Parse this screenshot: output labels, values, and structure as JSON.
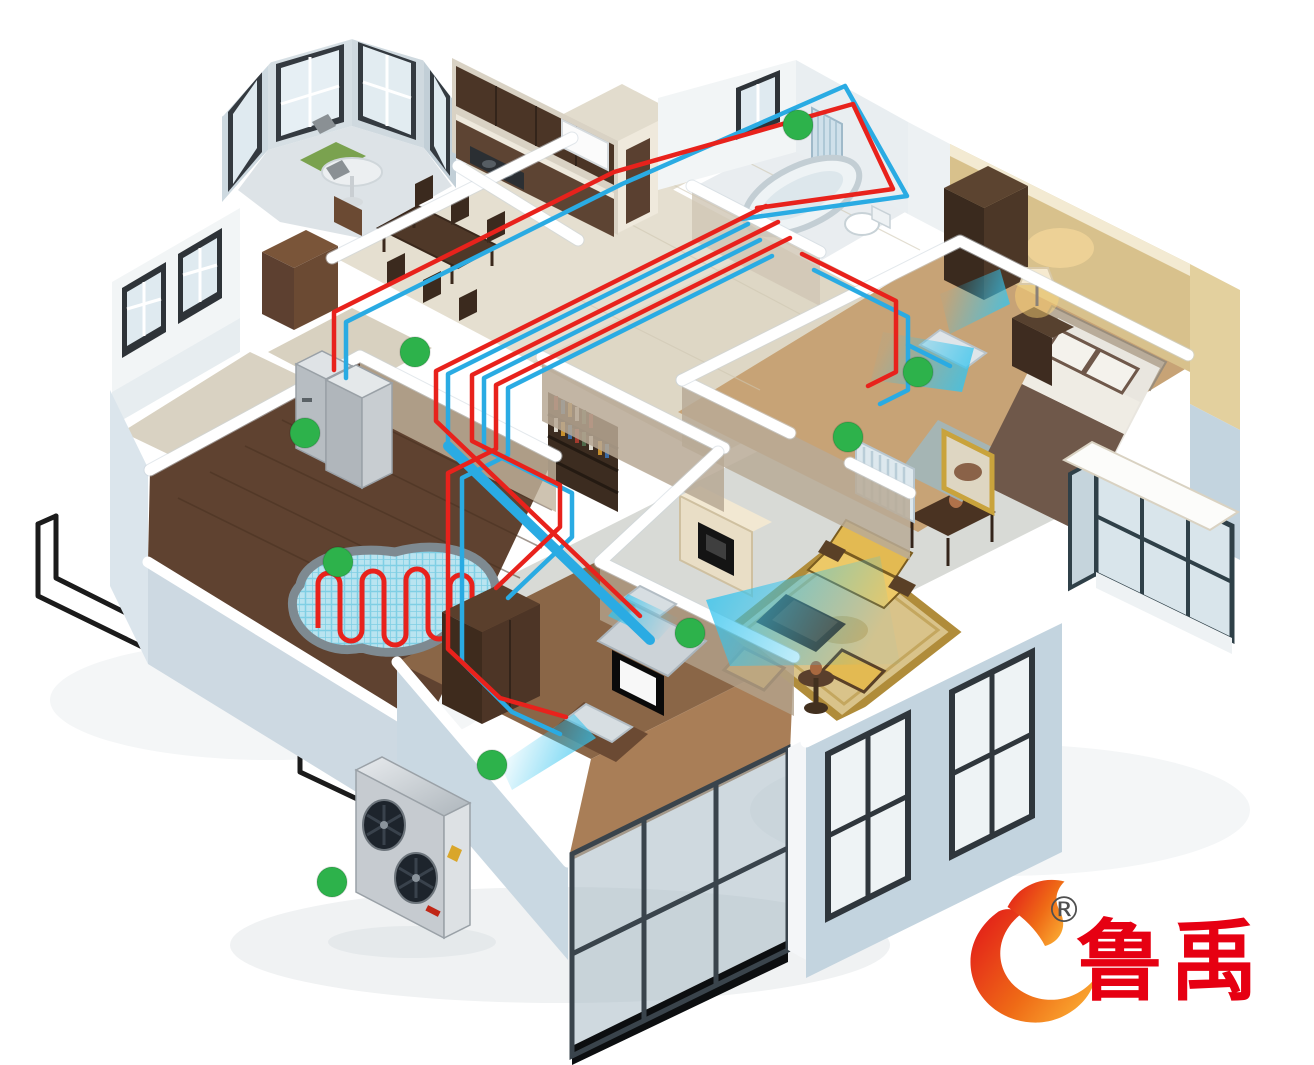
{
  "brand": {
    "logo_text": "鲁禹",
    "registered_mark": "®",
    "logo_color": "#e60012",
    "flame_gradient": [
      "#e32119",
      "#ef6b16",
      "#fbb034"
    ]
  },
  "palette": {
    "hot": "#e8221c",
    "cold": "#2aabe3",
    "pipe-black": "#1b1b1b",
    "marker": "#2db24b",
    "logo-red": "#e60012",
    "airflow": "#35c4ee"
  },
  "markers": {
    "shape": "circle",
    "radius": 15,
    "positions": [
      [
        798,
        125
      ],
      [
        415,
        352
      ],
      [
        305,
        433
      ],
      [
        918,
        372
      ],
      [
        848,
        437
      ],
      [
        338,
        562
      ],
      [
        690,
        633
      ],
      [
        492,
        765
      ],
      [
        332,
        882
      ]
    ]
  },
  "scene": {
    "type": "isometric-cutaway-home-heating-illustration",
    "elements": [
      "outdoor-heat-pump-unit",
      "indoor-hydronic-unit",
      "underfloor-heating-coil",
      "bathroom-towel-radiator",
      "bedroom-radiator",
      "fan-coil-units",
      "airflow-cones",
      "hot-water-pipes",
      "return-water-pipes",
      "exterior-ground-pipes",
      "location-markers"
    ]
  }
}
